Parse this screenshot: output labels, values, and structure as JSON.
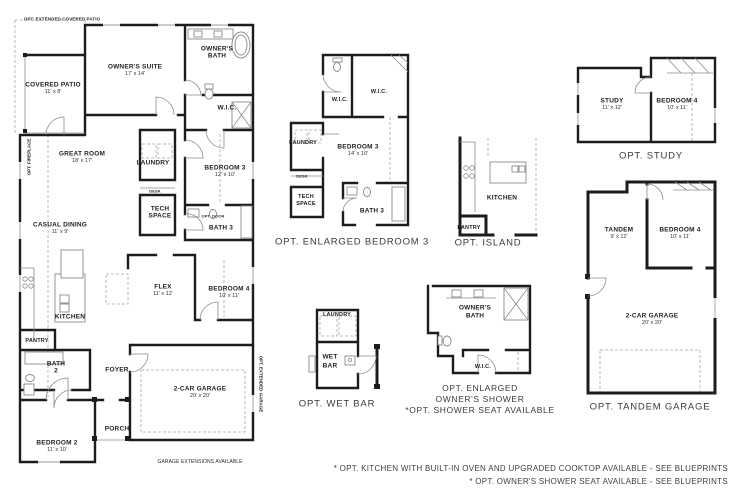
{
  "main": {
    "opt_patio": "OPT. EXTENDED COVERED PATIO",
    "opt_fireplace": "OPT. FIREPLACE",
    "opt_garage_side": "OPT. EXTENDED GARAGE",
    "garage_ext": "GARAGE EXTENSIONS AVAILABLE",
    "opt_door": "OPT. DOOR",
    "desk": "DESK",
    "rooms": {
      "covered_patio": {
        "name": "COVERED PATIO",
        "dim": "11' x 8'"
      },
      "owners_suite": {
        "name": "OWNER'S SUITE",
        "dim": "17' x 14'"
      },
      "owners_bath_1": "OWNER'S",
      "owners_bath_2": "BATH",
      "wic": "W.I.C.",
      "great_room": {
        "name": "GREAT ROOM",
        "dim": "18' x 17'"
      },
      "laundry": "LAUNDRY",
      "bedroom3": {
        "name": "BEDROOM 3",
        "dim": "12' x 10'"
      },
      "tech_1": "TECH",
      "tech_2": "SPACE",
      "bath3": "BATH 3",
      "casual_dining": {
        "name": "CASUAL DINING",
        "dim": "11' x 9'"
      },
      "flex": {
        "name": "FLEX",
        "dim": "11' x 12'"
      },
      "bedroom4": {
        "name": "BEDROOM 4",
        "dim": "10' x 11'"
      },
      "kitchen": "KITCHEN",
      "pantry": "PANTRY",
      "bath2_1": "BATH",
      "bath2_2": "2",
      "foyer": "FOYER",
      "garage": {
        "name": "2-CAR GARAGE",
        "dim": "20' x 20'"
      },
      "porch": "PORCH",
      "bedroom2": {
        "name": "BEDROOM 2",
        "dim": "11' x 10'"
      }
    }
  },
  "opt_bedroom3": {
    "caption": "OPT. ENLARGED BEDROOM 3",
    "wic_left": "W.I.C.",
    "wic_right": "W.I.C.",
    "laundry": "LAUNDRY",
    "bedroom3": {
      "name": "BEDROOM 3",
      "dim": "14' x 10'"
    },
    "desk": "DESK",
    "tech_1": "TECH",
    "tech_2": "SPACE",
    "bath3": "BATH 3"
  },
  "opt_island": {
    "caption": "OPT. ISLAND",
    "kitchen": "KITCHEN",
    "pantry": "PANTRY"
  },
  "opt_wet_bar": {
    "caption": "OPT. WET BAR",
    "laundry": "LAUNDRY",
    "wet": "WET",
    "bar": "BAR"
  },
  "opt_shower": {
    "caption_1": "OPT. ENLARGED",
    "caption_2": "OWNER'S SHOWER",
    "caption_3": "*OPT. SHOWER SEAT AVAILABLE",
    "owners_1": "OWNER'S",
    "owners_2": "BATH",
    "wic": "W.I.C."
  },
  "opt_study": {
    "caption": "OPT. STUDY",
    "study": {
      "name": "STUDY",
      "dim": "11' x 12'"
    },
    "bedroom4": {
      "name": "BEDROOM 4",
      "dim": "10' x 11'"
    }
  },
  "opt_tandem": {
    "caption": "OPT. TANDEM GARAGE",
    "tandem": {
      "name": "TANDEM",
      "dim": "9' x 12'"
    },
    "bedroom4": {
      "name": "BEDROOM 4",
      "dim": "10' x 11'"
    },
    "garage": {
      "name": "2-CAR GARAGE",
      "dim": "20' x 20'"
    }
  },
  "notes": {
    "line1": "* OPT. KITCHEN WITH BUILT-IN OVEN AND UPGRADED COOKTOP AVAILABLE - SEE BLUEPRINTS",
    "line2": "* OPT. OWNER'S SHOWER SEAT AVAILABLE - SEE BLUEPRINTS"
  }
}
